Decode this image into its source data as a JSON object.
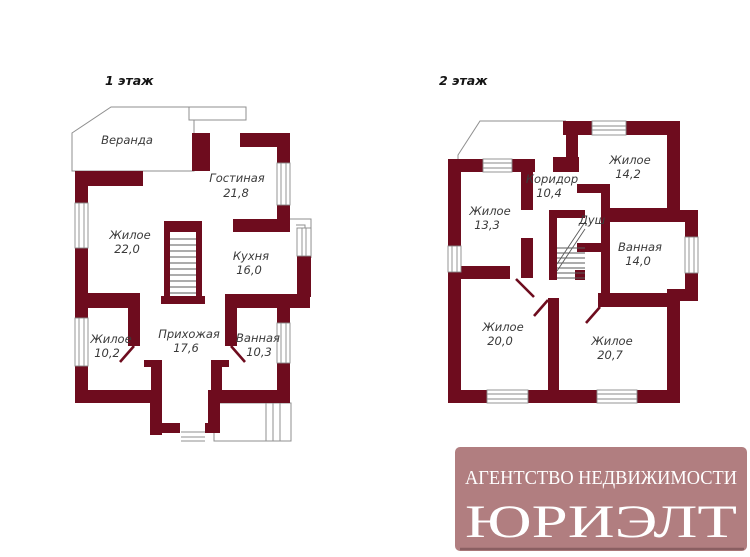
{
  "floor1": {
    "title": "1 этаж",
    "rooms": {
      "veranda": {
        "name": "Веранда",
        "area": ""
      },
      "gostinaya": {
        "name": "Гостиная",
        "area": "21,8"
      },
      "zhiloe_big": {
        "name": "Жилое",
        "area": "22,0"
      },
      "kuhnya": {
        "name": "Кухня",
        "area": "16,0"
      },
      "zhiloe_sm": {
        "name": "Жилое",
        "area": "10,2"
      },
      "prihozhaya": {
        "name": "Прихожая",
        "area": "17,6"
      },
      "vannaya": {
        "name": "Ванная",
        "area": "10,3"
      }
    }
  },
  "floor2": {
    "title": "2 этаж",
    "rooms": {
      "zhiloe_133": {
        "name": "Жилое",
        "area": "13,3"
      },
      "koridor": {
        "name": "Коридор",
        "area": "10,4"
      },
      "zhiloe_142": {
        "name": "Жилое",
        "area": "14,2"
      },
      "dush": {
        "name": "Душ",
        "area": ""
      },
      "vannaya": {
        "name": "Ванная",
        "area": "14,0"
      },
      "zhiloe_200": {
        "name": "Жилое",
        "area": "20,0"
      },
      "zhiloe_207": {
        "name": "Жилое",
        "area": "20,7"
      }
    }
  },
  "watermark": {
    "line1": "АГЕНТСТВО НЕДВИЖИМОСТИ",
    "line2": "ЮРИЭЛТ"
  },
  "colors": {
    "wall": "#6e0c1e",
    "logo_bg": "#b17e80",
    "logo_text": "#ffffff",
    "thin_line": "#8f8f8f"
  }
}
